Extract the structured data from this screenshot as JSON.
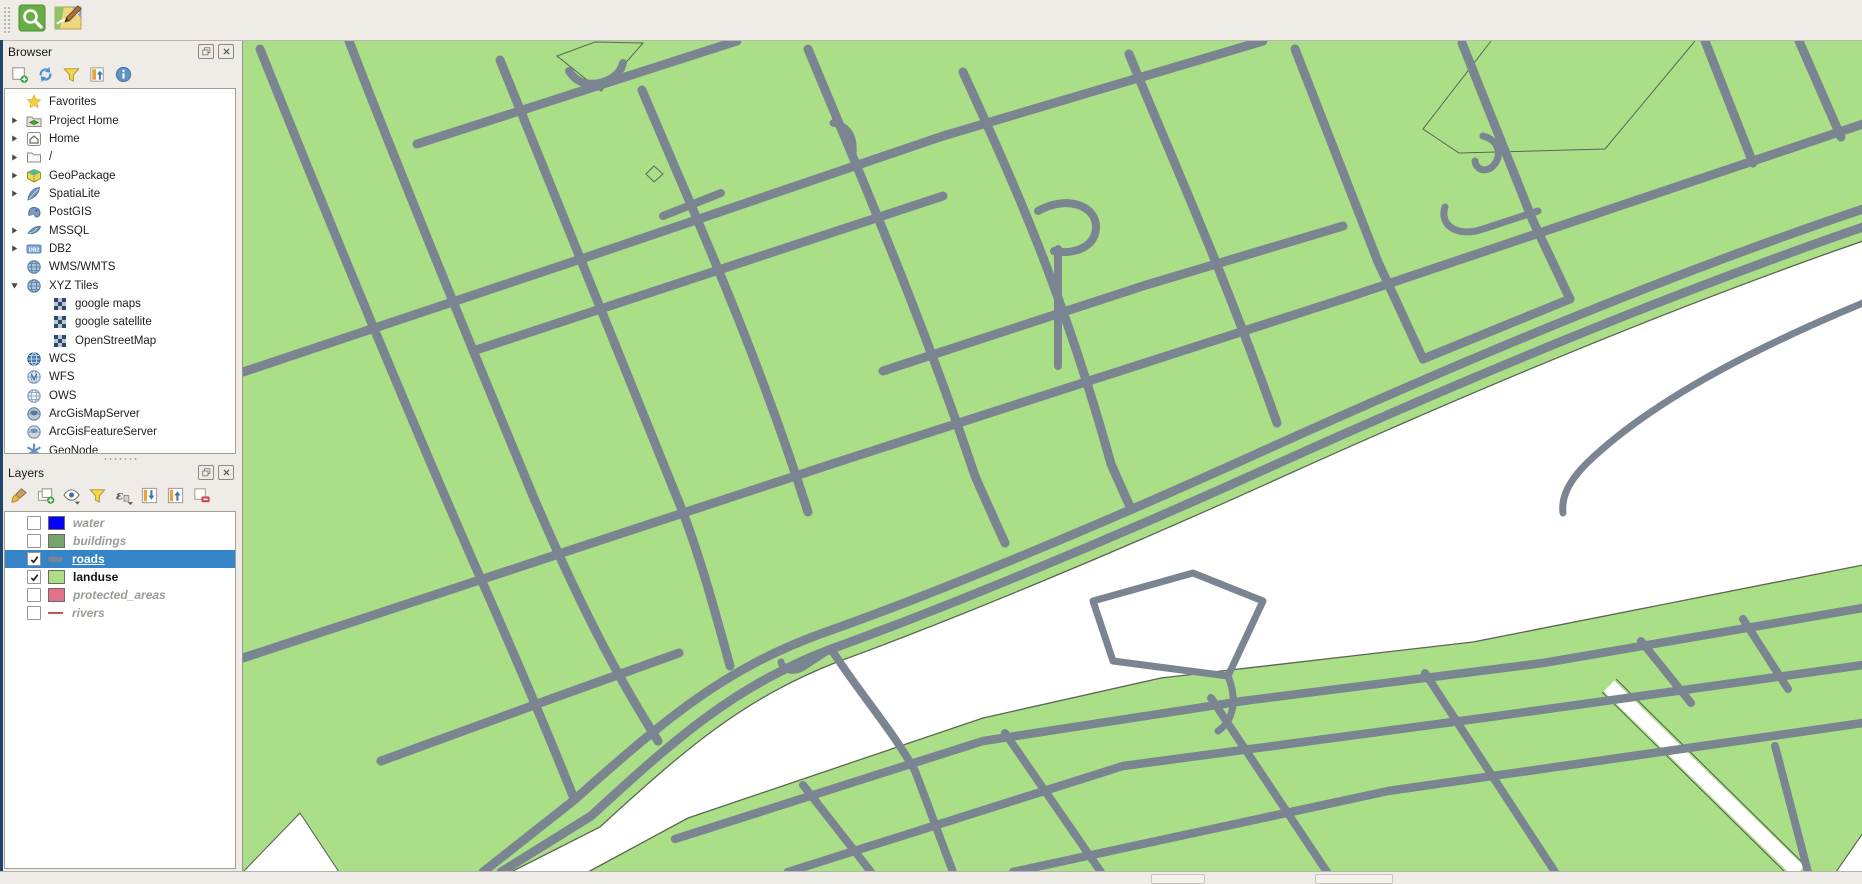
{
  "window": {
    "toolbar": [
      {
        "name": "osm-place-search",
        "icon": "osm-search"
      },
      {
        "name": "osm-edit",
        "icon": "osm-edit"
      }
    ]
  },
  "browser_panel": {
    "title": "Browser",
    "toolbar": [
      {
        "name": "add-selected-layers",
        "icon": "add-layer"
      },
      {
        "name": "refresh",
        "icon": "refresh"
      },
      {
        "name": "filter-browser",
        "icon": "funnel"
      },
      {
        "name": "collapse-all",
        "icon": "collapse-tree"
      },
      {
        "name": "properties",
        "icon": "info"
      }
    ],
    "items": [
      {
        "label": "Favorites",
        "icon": "star",
        "expander": "none",
        "indent": 1
      },
      {
        "label": "Project Home",
        "icon": "project-home",
        "expander": "right",
        "indent": 1
      },
      {
        "label": "Home",
        "icon": "home",
        "expander": "right",
        "indent": 1
      },
      {
        "label": "/",
        "icon": "folder",
        "expander": "right",
        "indent": 1
      },
      {
        "label": "GeoPackage",
        "icon": "geopackage",
        "expander": "right",
        "indent": 1
      },
      {
        "label": "SpatiaLite",
        "icon": "spatialite",
        "expander": "right",
        "indent": 1
      },
      {
        "label": "PostGIS",
        "icon": "postgis",
        "expander": "none",
        "indent": 1
      },
      {
        "label": "MSSQL",
        "icon": "mssql",
        "expander": "right",
        "indent": 1
      },
      {
        "label": "DB2",
        "icon": "db2",
        "expander": "right",
        "indent": 1
      },
      {
        "label": "WMS/WMTS",
        "icon": "globe",
        "expander": "none",
        "indent": 1
      },
      {
        "label": "XYZ Tiles",
        "icon": "globe",
        "expander": "down",
        "indent": 1
      },
      {
        "label": "google maps",
        "icon": "tiles",
        "expander": "none",
        "indent": 2
      },
      {
        "label": "google satellite",
        "icon": "tiles",
        "expander": "none",
        "indent": 2
      },
      {
        "label": "OpenStreetMap",
        "icon": "tiles",
        "expander": "none",
        "indent": 2
      },
      {
        "label": "WCS",
        "icon": "globe-solid",
        "expander": "none",
        "indent": 1
      },
      {
        "label": "WFS",
        "icon": "globe-wfs",
        "expander": "none",
        "indent": 1
      },
      {
        "label": "OWS",
        "icon": "globe-outline",
        "expander": "none",
        "indent": 1
      },
      {
        "label": "ArcGisMapServer",
        "icon": "globe-arcgis",
        "expander": "none",
        "indent": 1
      },
      {
        "label": "ArcGisFeatureServer",
        "icon": "globe-arcgis2",
        "expander": "none",
        "indent": 1
      },
      {
        "label": "GeoNode",
        "icon": "geonode",
        "expander": "none",
        "indent": 1
      }
    ]
  },
  "layers_panel": {
    "title": "Layers",
    "toolbar": [
      {
        "name": "open-layer-styling",
        "icon": "brush"
      },
      {
        "name": "add-group",
        "icon": "add-group"
      },
      {
        "name": "manage-map-themes",
        "icon": "eye"
      },
      {
        "name": "filter-legend",
        "icon": "funnel"
      },
      {
        "name": "filter-by-expression",
        "icon": "expression"
      },
      {
        "name": "expand-all",
        "icon": "expand-all"
      },
      {
        "name": "collapse-all",
        "icon": "collapse-all"
      },
      {
        "name": "remove-layer",
        "icon": "remove-layer"
      }
    ],
    "items": [
      {
        "label": "water",
        "checked": false,
        "selected": false,
        "swatch": "#0500fd",
        "swatch_type": "fill",
        "text_style": "dim"
      },
      {
        "label": "buildings",
        "checked": false,
        "selected": false,
        "swatch": "#77a36f",
        "swatch_type": "fill",
        "text_style": "dim"
      },
      {
        "label": "roads",
        "checked": true,
        "selected": true,
        "swatch": "#7a8591",
        "swatch_type": "line-thick",
        "text_style": "white"
      },
      {
        "label": "landuse",
        "checked": true,
        "selected": false,
        "swatch": "#aade87",
        "swatch_type": "fill",
        "text_style": "dark"
      },
      {
        "label": "protected_areas",
        "checked": false,
        "selected": false,
        "swatch": "#e2728c",
        "swatch_type": "fill",
        "text_style": "dim"
      },
      {
        "label": "rivers",
        "checked": false,
        "selected": false,
        "swatch": "#c35749",
        "swatch_type": "line-thin",
        "text_style": "dim"
      }
    ]
  },
  "map": {
    "land_color": "#aade87",
    "road_color": "#7a8591",
    "water_color": "#ffffff",
    "outline_color": "#5c6653",
    "selection_color": "#3584c8"
  }
}
